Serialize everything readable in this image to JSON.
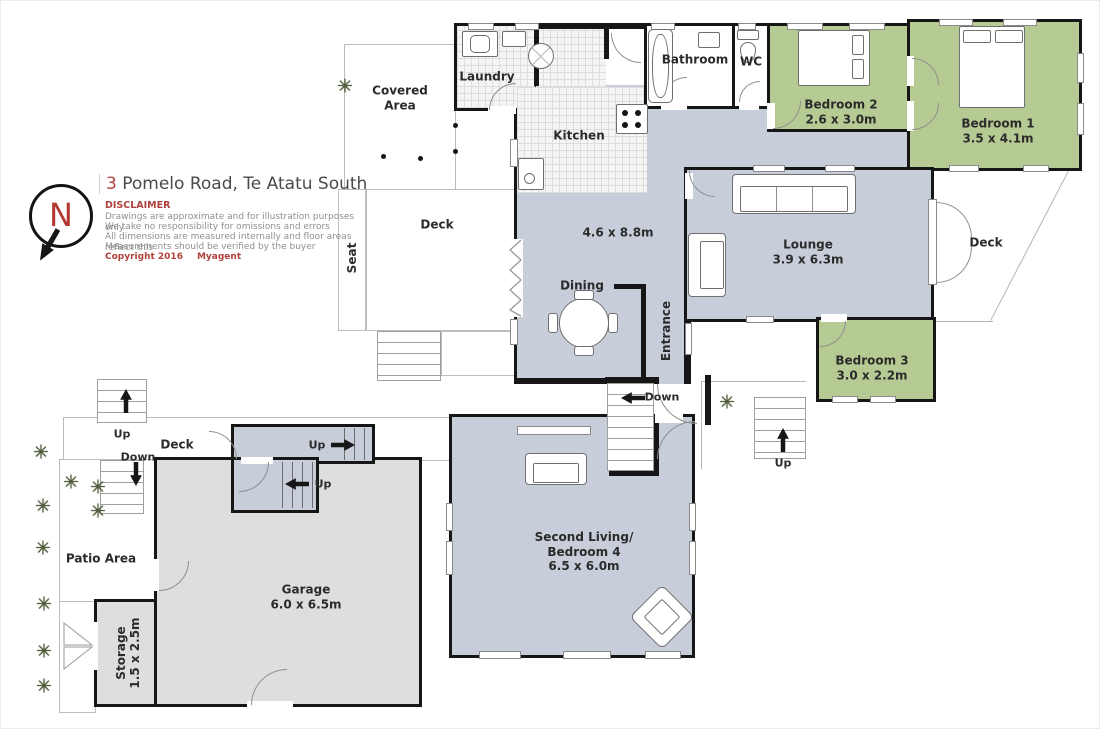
{
  "header": {
    "title_number": "3",
    "title_text": " Pomelo Road, Te Atatu South",
    "disclaimer_title": "DISCLAIMER",
    "disclaimer_lines": [
      "Drawings are approximate and for illustration purposes only",
      "We take no responsibility for omissions and errors",
      "All dimensions are measured internally and floor areas reflect this",
      "Measurements should be verified by the buyer"
    ],
    "copyright": "Copyright 2016",
    "agent": "Myagent"
  },
  "compass": {
    "letter": "N"
  },
  "rooms": {
    "covered_area": {
      "label": "Covered Area"
    },
    "seat": {
      "label": "Seat"
    },
    "deck_upper": {
      "label": "Deck"
    },
    "laundry": {
      "label": "Laundry"
    },
    "kitchen": {
      "label": "Kitchen"
    },
    "bathroom": {
      "label": "Bathroom"
    },
    "wc": {
      "label": "WC"
    },
    "bedroom1": {
      "label": "Bedroom 1",
      "dims": "3.5 x 4.1m"
    },
    "bedroom2": {
      "label": "Bedroom 2",
      "dims": "2.6 x 3.0m"
    },
    "bedroom3": {
      "label": "Bedroom 3",
      "dims": "3.0 x 2.2m"
    },
    "living_area": {
      "dims": "4.6 x 8.8m"
    },
    "dining": {
      "label": "Dining"
    },
    "lounge": {
      "label": "Lounge",
      "dims": "3.9 x 6.3m"
    },
    "entrance": {
      "label": "Entrance"
    },
    "deck_right": {
      "label": "Deck"
    },
    "deck_lower": {
      "label": "Deck"
    },
    "patio": {
      "label": "Patio Area"
    },
    "garage": {
      "label": "Garage",
      "dims": "6.0 x 6.5m"
    },
    "storage": {
      "label": "Storage",
      "dims": "1.5 x 2.5m"
    },
    "second_living": {
      "label_line1": "Second Living/",
      "label_line2": "Bedroom 4",
      "dims": "6.5 x 6.0m"
    }
  },
  "nav": {
    "up": "Up",
    "down": "Down"
  },
  "icons": {
    "plant": "✳"
  },
  "colors": {
    "floor_main": "#c7ced9",
    "bedroom_green": "#b6cb93",
    "garage_gray": "#dedede",
    "wall_black": "#161616",
    "accent_red": "#b0413c",
    "outline_gray": "#b5b5b5"
  }
}
